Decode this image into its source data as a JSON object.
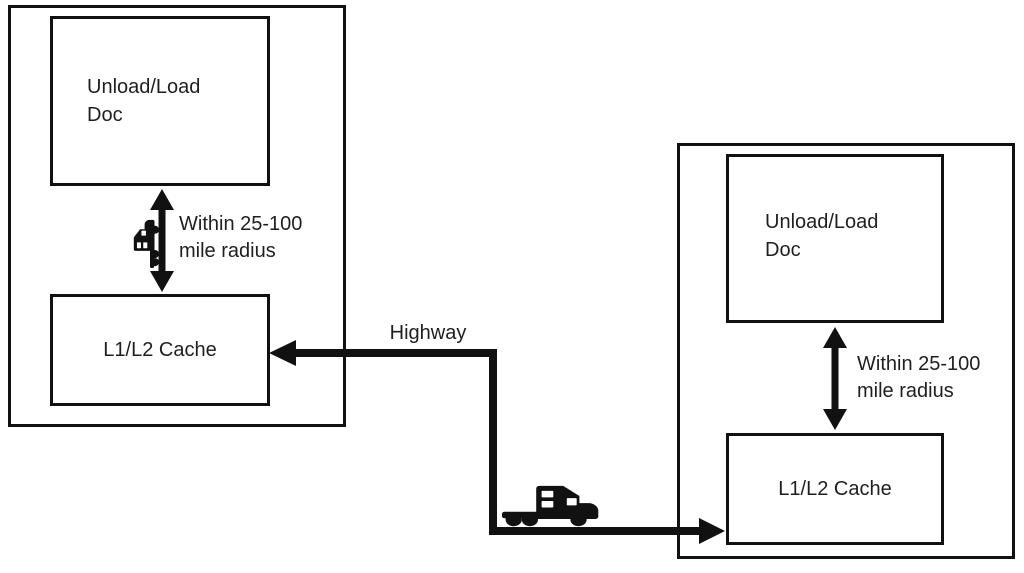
{
  "facilities": {
    "left": {
      "dock_label": "Unload/Load Doc",
      "cache_label": "L1/L2 Cache",
      "radius_note": "Within 25-100 mile radius"
    },
    "right": {
      "dock_label": "Unload/Load Doc",
      "cache_label": "L1/L2 Cache",
      "radius_note": "Within 25-100 mile radius"
    }
  },
  "highway": {
    "label": "Highway"
  },
  "icons": {
    "left_connector": "truck-icon",
    "highway_connector": "truck-icon"
  },
  "colors": {
    "line": "#111111",
    "text": "#1f1f1f",
    "background": "#ffffff"
  }
}
